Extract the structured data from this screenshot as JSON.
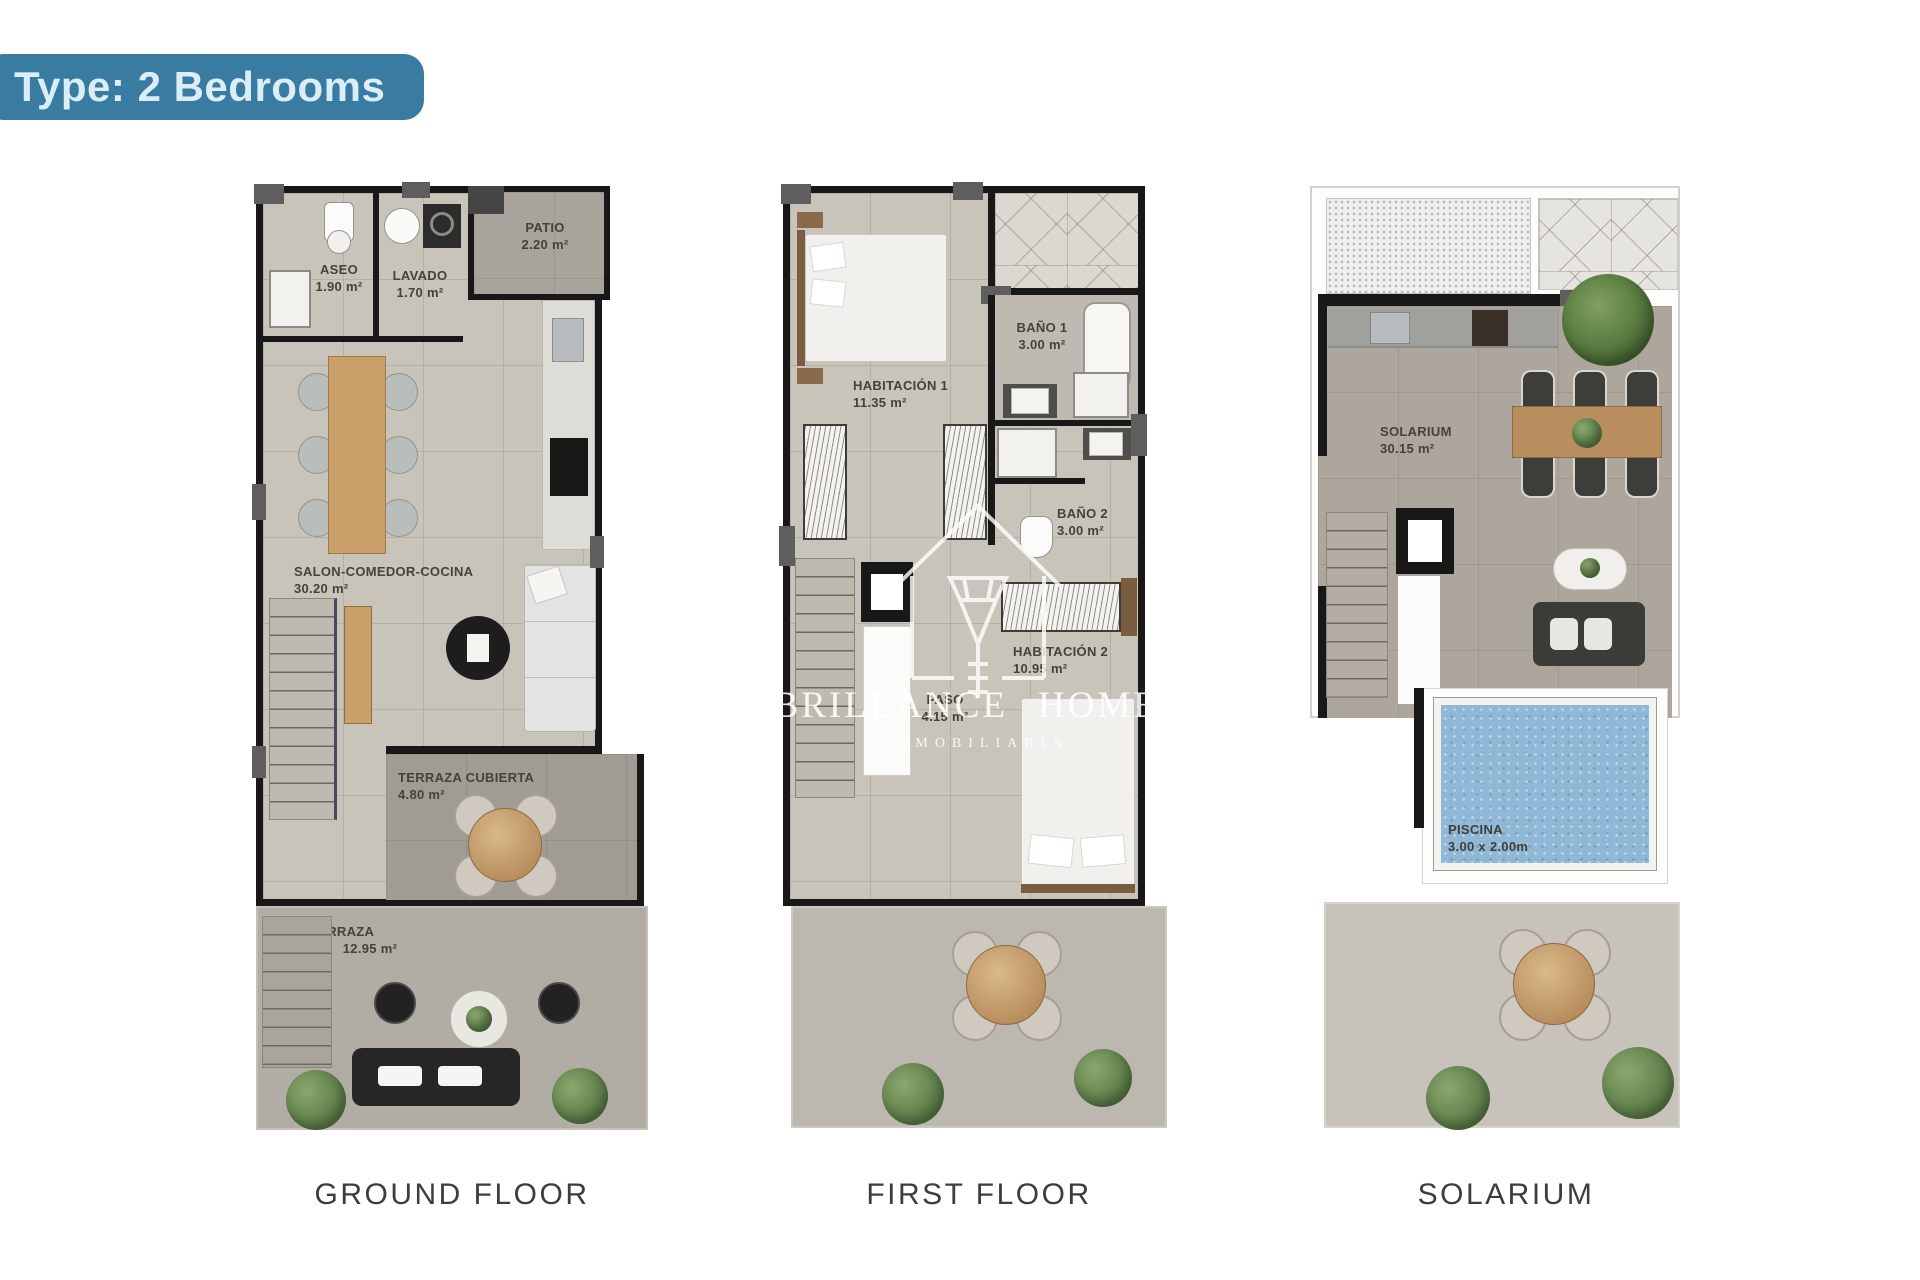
{
  "header": {
    "badge_label": "Type: 2 Bedrooms"
  },
  "colors": {
    "badge_bg": "#3a7ba1",
    "badge_text": "#d9eef7",
    "wall": "#181818",
    "wall_accent": "#5e5e5e",
    "floor_main": "#c9c4ba",
    "floor_patio": "#a8a39b",
    "floor_terrace": "#b1aca4",
    "floor_terrace_light": "#c7c3bb",
    "pool_water": "#8fb7d6",
    "wood": "#b98e5e",
    "plant_green": "#5f7f4a",
    "caption_text": "#3d3d3d",
    "label_text": "#45423b"
  },
  "watermark": {
    "brand_line1": "BRILLANCE",
    "brand_line2": "HOMES",
    "subtitle": "INMOBILIARIA"
  },
  "plans": [
    {
      "caption": "GROUND FLOOR",
      "rooms": [
        {
          "name": "ASEO",
          "area": "1.90 m²"
        },
        {
          "name": "LAVADO",
          "area": "1.70 m²"
        },
        {
          "name": "PATIO",
          "area": "2.20 m²"
        },
        {
          "name": "SALON-COMEDOR-COCINA",
          "area": "30.20 m²"
        },
        {
          "name": "TERRAZA CUBIERTA",
          "area": "4.80 m²"
        },
        {
          "name": "TERRAZA",
          "area": "12.95 m²"
        }
      ]
    },
    {
      "caption": "FIRST FLOOR",
      "rooms": [
        {
          "name": "HABITACIÓN 1",
          "area": "11.35 m²"
        },
        {
          "name": "BAÑO 1",
          "area": "3.00 m²"
        },
        {
          "name": "BAÑO 2",
          "area": "3.00 m²"
        },
        {
          "name": "PASO",
          "area": "4.15 m²"
        },
        {
          "name": "HABITACIÓN 2",
          "area": "10.95 m²"
        }
      ]
    },
    {
      "caption": "SOLARIUM",
      "rooms": [
        {
          "name": "SOLARIUM",
          "area": "30.15 m²"
        },
        {
          "name": "PISCINA",
          "area": "3.00 x 2.00m"
        }
      ]
    }
  ]
}
